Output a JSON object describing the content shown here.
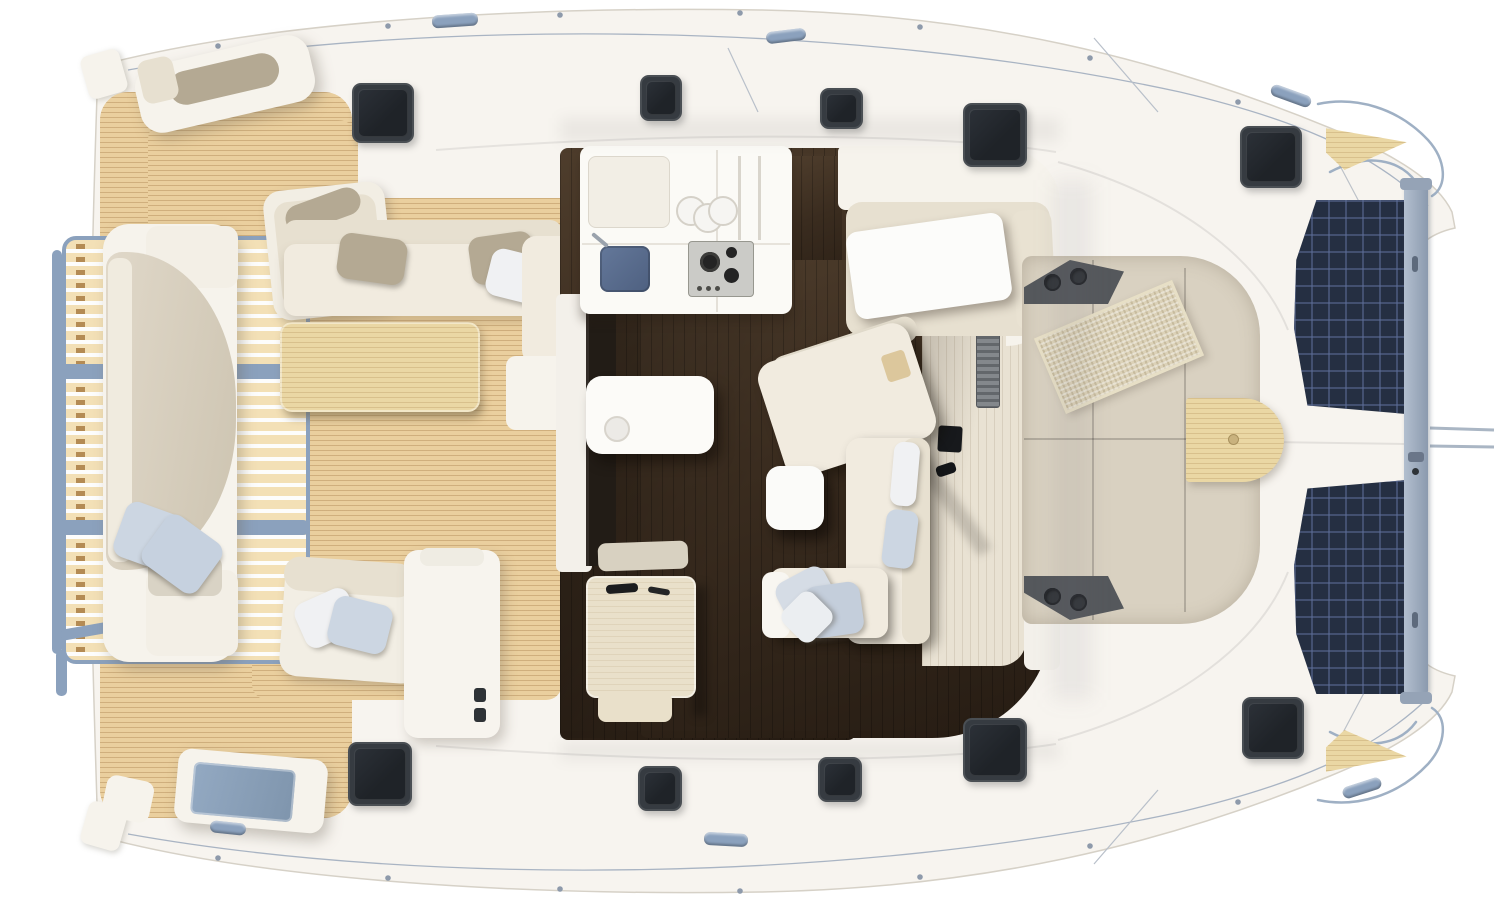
{
  "scene": {
    "subject": "catamaran-deck-plan-top-view",
    "view": "overhead 3D render of a sailing catamaran main deck and saloon, bow pointing right",
    "visible_text": []
  },
  "regions": {
    "aft_platform": "teak slatted swim platform with metal frame",
    "aft_cockpit": "teak cockpit with central bench, corner seats, dining table and long bench",
    "galley": "L-shaped galley with sink, glasses, prep sink and gas hob",
    "saloon": "dark wood sole, L-shaped sofa, coffee table, nav desk, dinette",
    "forward_cockpit": "beige lounge sunpads with cup-holder corners, mat and wood table",
    "foredeck": "deck hatches, cleats, twin trampolines, forward crossbeam, bow teak pads"
  },
  "counts": {
    "deck_hatches": 10,
    "trampolines": 2,
    "cleats": 6
  },
  "palette": {
    "bg": "#ffffff",
    "hull": "#f7f4ef",
    "hull-edge": "#d6d1c7",
    "teak": "#eacf9e",
    "teak-line": "#a97c42",
    "slat": "#f3e0b6",
    "metal": "#8ba1bd",
    "cream": "#f1ebdf",
    "cream-dark": "#e7e0d0",
    "white-soft": "#f6f3ec",
    "taupe": "#d9d1c1",
    "bolster": "#b4a993",
    "pillow-blue": "#ccd6e2",
    "pillow-white": "#f0f1f3",
    "floor-a": "#4e3d2c",
    "floor-b": "#261c13",
    "counter": "#fbfaf6",
    "navy": "#5b6e8c",
    "stove": "#cbcbc7",
    "hatch-frame": "#363b41",
    "hatch-glass": "#1f2328",
    "tramp": "#252f42",
    "beam-a": "#b3bfcf",
    "beam-b": "#8b9aae",
    "glass": "#8ba3bd",
    "walkway": "#e9e2d3",
    "corner-grey": "#55585c",
    "wood": "#ead7a4",
    "rug": "#dcd2b8"
  }
}
